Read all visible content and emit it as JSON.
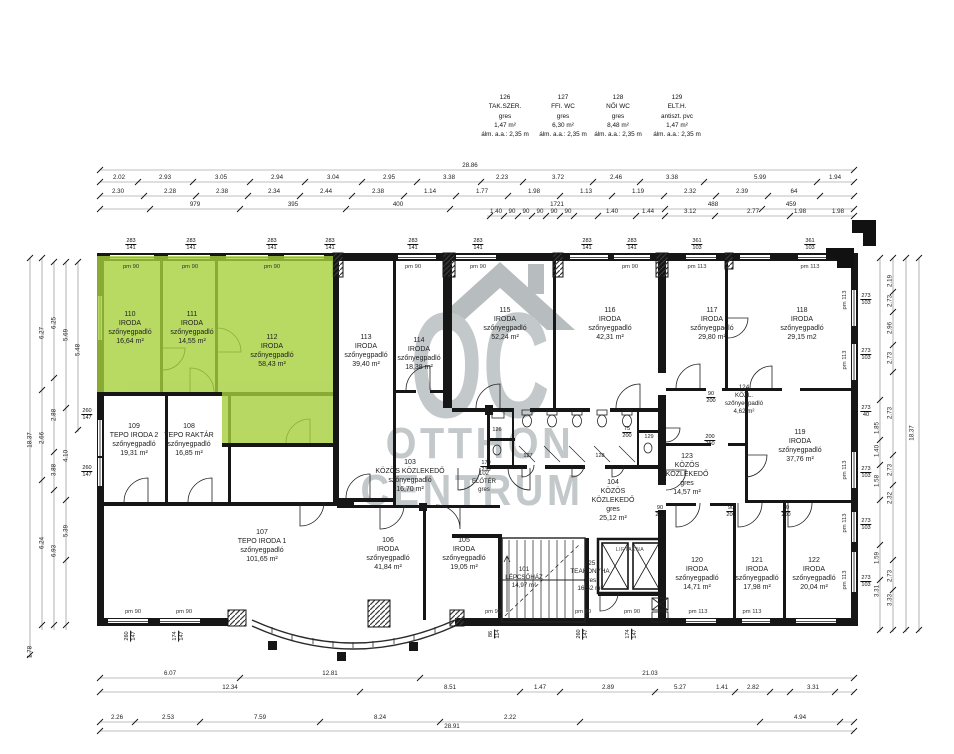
{
  "legend": {
    "items": [
      {
        "n": "126",
        "t": "TAK.SZER.",
        "f": "gres",
        "a": "1,47 m²",
        "h": "álm. a.a.: 2,35 m"
      },
      {
        "n": "127",
        "t": "FFI. WC",
        "f": "gres",
        "a": "6,30 m²",
        "h": "álm. a.a.: 2,35 m"
      },
      {
        "n": "128",
        "t": "NŐI WC",
        "f": "gres",
        "a": "8,48 m²",
        "h": "álm. a.a.: 2,35 m"
      },
      {
        "n": "129",
        "t": "ELT.H.",
        "f": "antiszt. pvc",
        "a": "1,47 m²",
        "h": "álm. a.a.: 2,35 m"
      }
    ]
  },
  "watermark": {
    "logo": "OC",
    "word1": "OTTHON",
    "word2": "CENTRUM"
  },
  "highlight_color": "#a6cf3b",
  "rooms": [
    {
      "n": "110",
      "t": "IRODA",
      "f": "szőnyegpadló",
      "a": "16,64 m²"
    },
    {
      "n": "111",
      "t": "IRODA",
      "f": "szőnyegpadló",
      "a": "14,55 m²"
    },
    {
      "n": "112",
      "t": "IRODA",
      "f": "szőnyegpadló",
      "a": "58,43 m²"
    },
    {
      "n": "113",
      "t": "IRODA",
      "f": "szőnyegpadló",
      "a": "39,40 m²"
    },
    {
      "n": "114",
      "t": "IRODA",
      "f": "szőnyegpadló",
      "a": "18,38 m²"
    },
    {
      "n": "115",
      "t": "IRODA",
      "f": "szőnyegpadló",
      "a": "52,24 m²"
    },
    {
      "n": "116",
      "t": "IRODA",
      "f": "szőnyegpadló",
      "a": "42,31 m²"
    },
    {
      "n": "117",
      "t": "IRODA",
      "f": "szőnyegpadló",
      "a": "29,80 m²"
    },
    {
      "n": "118",
      "t": "IRODA",
      "f": "szőnyegpadló",
      "a": "29,15 m2"
    },
    {
      "n": "119",
      "t": "IRODA",
      "f": "szőnyegpadló",
      "a": "37,76 m²"
    },
    {
      "n": "120",
      "t": "IRODA",
      "f": "szőnyegpadló",
      "a": "14,71 m²"
    },
    {
      "n": "121",
      "t": "IRODA",
      "f": "szőnyegpadló",
      "a": "17,98 m²"
    },
    {
      "n": "122",
      "t": "IRODA",
      "f": "szőnyegpadló",
      "a": "20,04 m²"
    },
    {
      "n": "123",
      "t": "KÖZÖS KÖZLEKEDŐ",
      "f": "gres",
      "a": "14,57 m²"
    },
    {
      "n": "124",
      "t": "KÖZL.",
      "f": "szőnyegpadló",
      "a": "4,62 m²"
    },
    {
      "n": "125",
      "t": "TEAKONYHA",
      "f": "gres",
      "a": "16,52 m²"
    },
    {
      "n": "103",
      "t": "KÖZÖS KÖZLEKEDŐ",
      "f": "szőnyegpadló",
      "a": "16,70 m²"
    },
    {
      "n": "104",
      "t": "KÖZÖS KÖZLEKEDŐ",
      "f": "gres",
      "a": "25,12 m²"
    },
    {
      "n": "105",
      "t": "IRODA",
      "f": "szőnyegpadló",
      "a": "19,05 m²"
    },
    {
      "n": "106",
      "t": "IRODA",
      "f": "szőnyegpadló",
      "a": "41,84 m²"
    },
    {
      "n": "107",
      "t": "TEPO IRODA 1",
      "f": "szőnyegpadló",
      "a": "101,65 m²"
    },
    {
      "n": "108",
      "t": "TEPO RAKTÁR",
      "f": "szőnyegpadló",
      "a": "16,85 m²"
    },
    {
      "n": "109",
      "t": "TEPO IRODA 2",
      "f": "szőnyegpadló",
      "a": "19,31 m²"
    },
    {
      "n": "101",
      "t": "LÉPCSŐHÁZ",
      "f": "",
      "a": "14,97 m²"
    },
    {
      "n": "102",
      "t": "ELŐTÉR",
      "f": "gres",
      "a": ""
    }
  ],
  "sanitary": {
    "s1": "126",
    "s2": "127",
    "s3": "128",
    "s4": "129"
  },
  "lift": "LIFTAKNA",
  "dims": {
    "top_total": "28.86",
    "top1": [
      "2.02",
      "2.93",
      "3.05",
      "2.94",
      "3.04",
      "2.95",
      "3.38",
      "2.23",
      "3.72",
      "2.46",
      "3.38",
      "5.99",
      "1.94"
    ],
    "top2": [
      "2.30",
      "2.28",
      "2.38",
      "2.34",
      "2.44",
      "2.38",
      "1.14",
      "1.77",
      "1.98",
      "1.13",
      "1.19",
      "2.32",
      "2.39",
      "64"
    ],
    "top3": [
      "979",
      "395",
      "400",
      "1721",
      "488",
      "459"
    ],
    "top4": [
      "1.40",
      "90",
      "90",
      "90",
      "90",
      "90",
      "1.40",
      "1.44",
      "3.12",
      "2.77",
      "1.98",
      "1.98"
    ],
    "bottomA": [
      "6.07",
      "12.81",
      "21.03"
    ],
    "bottomB": [
      "12.34",
      "8.51",
      "1.47",
      "2.89",
      "5.27",
      "1.41",
      "2.82",
      "3.31"
    ],
    "bottomC": [
      "2.26",
      "2.53",
      "7.59",
      "8.24",
      "2.22",
      "4.94"
    ],
    "bottom_total": "28.91",
    "left": [
      "18.37",
      "6.27",
      "2.66",
      "6.24",
      "6.25",
      "2.88",
      "3.88",
      "6.93",
      "5.69",
      "4.10",
      "5.39",
      "5.48",
      "1.78"
    ],
    "right": [
      "2.19",
      "2.73",
      "2.96",
      "2.73",
      "2.73",
      "2.73",
      "2.32",
      "2.73",
      "3.33",
      "1.85",
      "1.40",
      "1.58",
      "1.59",
      "3.31",
      "18.37"
    ]
  },
  "marks": {
    "pm90": "pm 90",
    "pm113": "pm 113",
    "w283": "283",
    "w141": "141",
    "w361": "361",
    "w103": "103",
    "w260": "260",
    "w147": "147",
    "w174": "174",
    "w273": "273",
    "w40": "40",
    "d90": "90",
    "d200": "200",
    "d75": "75",
    "d250": "250",
    "d170": "170",
    "d233": "233",
    "d86": "86",
    "d114": "114"
  }
}
